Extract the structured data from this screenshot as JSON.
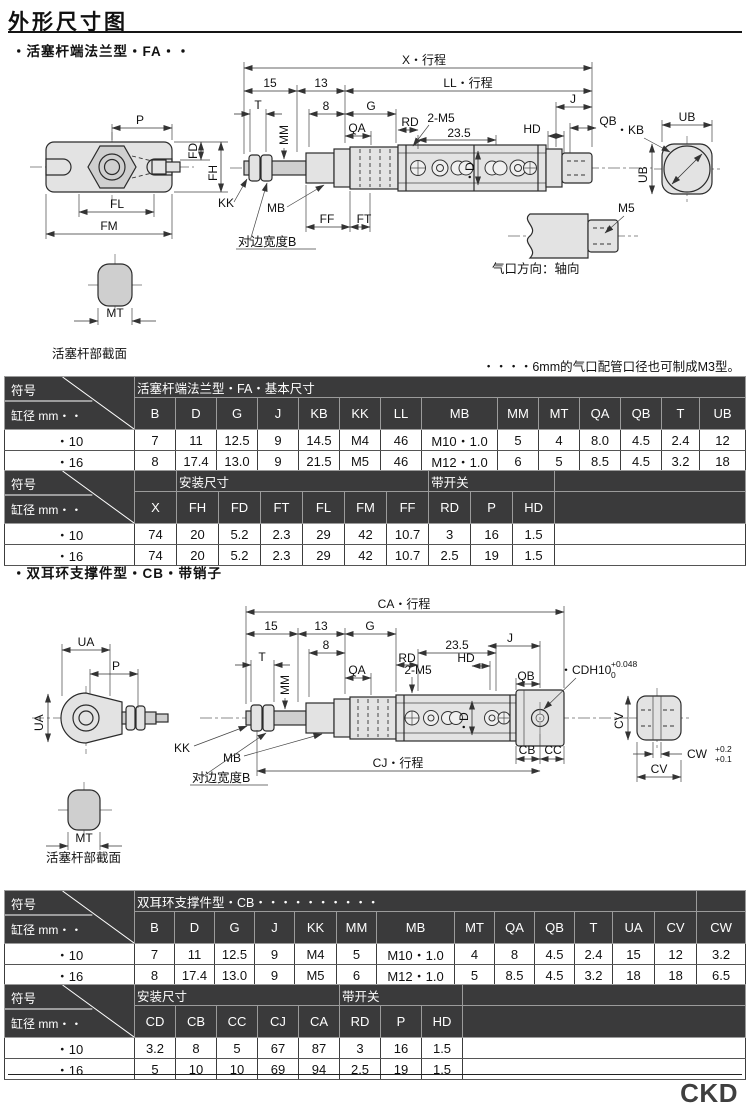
{
  "page": {
    "title": "外形尺寸图",
    "brand": "CKD"
  },
  "sections": {
    "s1": {
      "heading": "・活塞杆端法兰型・FA・・",
      "note": "・・・・6mm的气口配管口径也可制成M3型。"
    },
    "s2": {
      "heading": "・双耳环支撑件型・CB・带销子"
    }
  },
  "d1": {
    "x_stroke": "X・行程",
    "n15": "15",
    "n13": "13",
    "ll_stroke": "LL・行程",
    "t": "T",
    "n8": "8",
    "g": "G",
    "j": "J",
    "qa": "QA",
    "rd": "RD",
    "two_m5": "2-M5",
    "n235": "23.5",
    "mm": "MM",
    "hd": "HD",
    "qb": "QB",
    "kb": "・KB",
    "ub_top": "UB",
    "ub_left": "UB",
    "dia": "・D",
    "p": "P",
    "fd": "FD",
    "fh": "FH",
    "fl": "FL",
    "fm": "FM",
    "kk": "KK",
    "mb": "MB",
    "ff": "FF",
    "ft": "FT",
    "flats": "对边宽度B",
    "m5": "M5",
    "port_dir": "气口方向：轴向",
    "mt": "MT",
    "rod_section": "活塞杆部截面"
  },
  "d2": {
    "ca_stroke": "CA・行程",
    "n15": "15",
    "n13": "13",
    "g": "G",
    "n8": "8",
    "rd": "RD",
    "n235": "23.5",
    "qa": "QA",
    "two_m5": "2-M5",
    "t": "T",
    "mm": "MM",
    "hd": "HD",
    "j": "J",
    "qb": "QB",
    "dia": "・D",
    "cdh": "・CDH10",
    "cdh_sup": "+0.048",
    "cdh_sub": "0",
    "ua_top": "UA",
    "p": "P",
    "ua_left": "UA",
    "kk": "KK",
    "mb": "MB",
    "flats": "对边宽度B",
    "cb": "CB",
    "cc": "CC",
    "cj_stroke": "CJ・行程",
    "cv_left": "CV",
    "cv_bottom": "CV",
    "cw": "CW",
    "cw_sup": "+0.2",
    "cw_sub": "+0.1",
    "mt": "MT",
    "rod_section": "活塞杆部截面"
  },
  "tables": {
    "t1": {
      "corner_top": "符号",
      "corner_bottom": "缸径 mm・・",
      "groups": [
        {
          "label": "活塞杆端法兰型・FA・基本尺寸",
          "span": 14
        }
      ],
      "cols": [
        "B",
        "D",
        "G",
        "J",
        "KB",
        "KK",
        "LL",
        "MB",
        "MM",
        "MT",
        "QA",
        "QB",
        "T",
        "UB"
      ],
      "rows": [
        [
          "・10",
          "7",
          "11",
          "12.5",
          "9",
          "14.5",
          "M4",
          "46",
          "M10・1.0",
          "5",
          "4",
          "8.0",
          "4.5",
          "2.4",
          "12"
        ],
        [
          "・16",
          "8",
          "17.4",
          "13.0",
          "9",
          "21.5",
          "M5",
          "46",
          "M12・1.0",
          "6",
          "5",
          "8.5",
          "4.5",
          "3.2",
          "18"
        ]
      ]
    },
    "t2": {
      "corner_top": "符号",
      "corner_bottom": "缸径 mm・・",
      "groups": [
        {
          "label": "",
          "span": 1
        },
        {
          "label": "安装尺寸",
          "span": 6
        },
        {
          "label": "带开关",
          "span": 3
        },
        {
          "label": "",
          "span": 1
        }
      ],
      "cols": [
        "X",
        "FH",
        "FD",
        "FT",
        "FL",
        "FM",
        "FF",
        "RD",
        "P",
        "HD",
        ""
      ],
      "rows": [
        [
          "・10",
          "74",
          "20",
          "5.2",
          "2.3",
          "29",
          "42",
          "10.7",
          "3",
          "16",
          "1.5",
          ""
        ],
        [
          "・16",
          "74",
          "20",
          "5.2",
          "2.3",
          "29",
          "42",
          "10.7",
          "2.5",
          "19",
          "1.5",
          ""
        ]
      ]
    },
    "t3": {
      "corner_top": "符号",
      "corner_bottom": "缸径 mm・・",
      "groups": [
        {
          "label": "双耳环支撑件型・CB・・・・・・・・・・",
          "span": 13
        },
        {
          "label": "",
          "span": 1
        }
      ],
      "cols": [
        "B",
        "D",
        "G",
        "J",
        "KK",
        "MM",
        "MB",
        "MT",
        "QA",
        "QB",
        "T",
        "UA",
        "CV",
        "CW"
      ],
      "rows": [
        [
          "・10",
          "7",
          "11",
          "12.5",
          "9",
          "M4",
          "5",
          "M10・1.0",
          "4",
          "8",
          "4.5",
          "2.4",
          "15",
          "12",
          "3.2"
        ],
        [
          "・16",
          "8",
          "17.4",
          "13.0",
          "9",
          "M5",
          "6",
          "M12・1.0",
          "5",
          "8.5",
          "4.5",
          "3.2",
          "18",
          "18",
          "6.5"
        ]
      ]
    },
    "t4": {
      "corner_top": "符号",
      "corner_bottom": "缸径 mm・・",
      "groups": [
        {
          "label": "安装尺寸",
          "span": 5
        },
        {
          "label": "带开关",
          "span": 3
        },
        {
          "label": "",
          "span": 1
        }
      ],
      "cols": [
        "CD",
        "CB",
        "CC",
        "CJ",
        "CA",
        "RD",
        "P",
        "HD",
        ""
      ],
      "rows": [
        [
          "・10",
          "3.2",
          "8",
          "5",
          "67",
          "87",
          "3",
          "16",
          "1.5",
          ""
        ],
        [
          "・16",
          "5",
          "10",
          "10",
          "69",
          "94",
          "2.5",
          "19",
          "1.5",
          ""
        ]
      ]
    }
  }
}
